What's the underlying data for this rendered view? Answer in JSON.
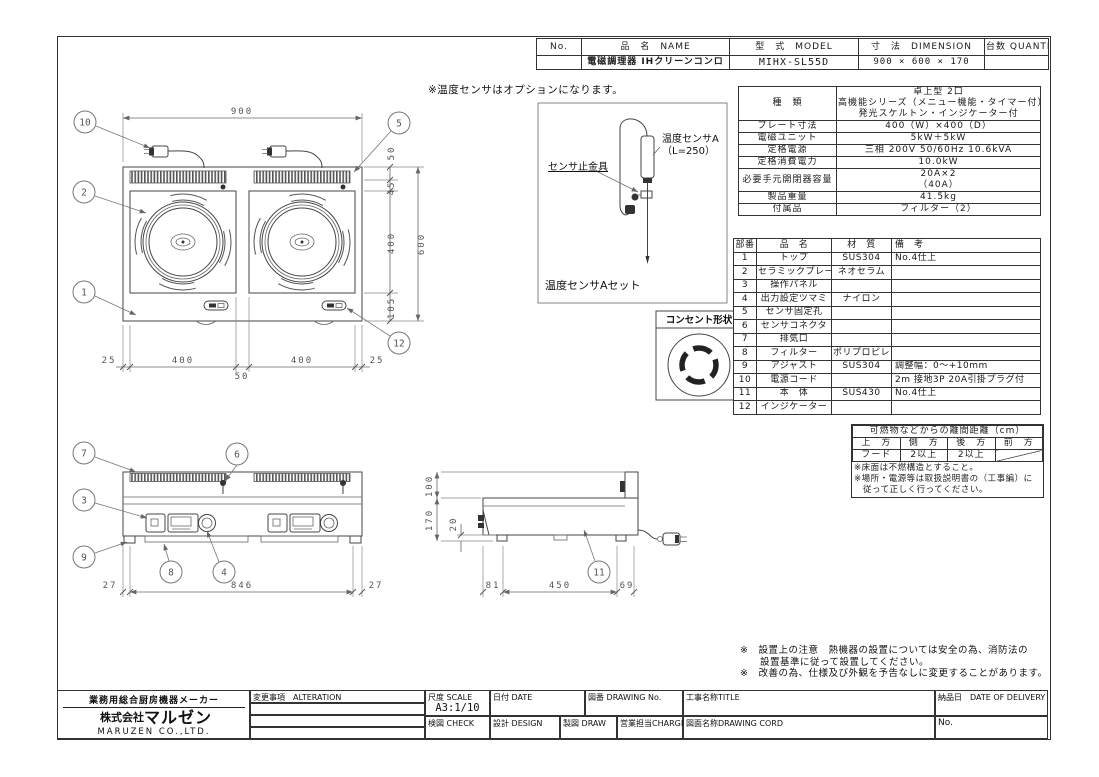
{
  "header_table": {
    "columns": [
      "No.",
      "品　名　NAME",
      "型　式　MODEL",
      "寸　法　DIMENSION",
      "台数 QUANTITY"
    ],
    "row": {
      "no": "",
      "name": "電磁調理器 IHクリーンコンロ",
      "model": "MIHX-SL55D",
      "dimension": "900 × 600 × 170",
      "quantity": ""
    }
  },
  "sensor_inset": {
    "note": "※温度センサはオプションになります。",
    "label_sensor": "温度センサA",
    "label_sensor_length": "（L=250）",
    "label_fitting": "センサ止金具",
    "caption": "温度センサAセット"
  },
  "outlet": {
    "title": "コンセント形状"
  },
  "spec_table": {
    "rows": [
      [
        "種　類",
        [
          "卓上型 2口",
          "高機能シリーズ（メニュー機能・タイマー付）",
          "発光スケルトン・インジケーター付"
        ]
      ],
      [
        "プレート寸法",
        "400（W）×400（D）"
      ],
      [
        "電磁ユニット",
        "5kW＋5kW"
      ],
      [
        "定格電源",
        "三相 200V 50/60Hz 10.6kVA"
      ],
      [
        "定格消費電力",
        "10.0kW"
      ],
      [
        "必要手元開閉器容量",
        [
          "20A×2",
          "（40A）"
        ]
      ],
      [
        "製品重量",
        "41.5kg"
      ],
      [
        "付属品",
        "フィルター（2）"
      ]
    ]
  },
  "parts_table": {
    "columns": [
      "部番",
      "品　名",
      "材　質",
      "備　考"
    ],
    "rows": [
      [
        "1",
        "トップ",
        "SUS304",
        "No.4仕上"
      ],
      [
        "2",
        "セラミックプレート",
        "ネオセラム",
        ""
      ],
      [
        "3",
        "操作パネル",
        "",
        ""
      ],
      [
        "4",
        "出力設定ツマミ",
        "ナイロン",
        ""
      ],
      [
        "5",
        "センサ固定孔",
        "",
        ""
      ],
      [
        "6",
        "センサコネクタ",
        "",
        ""
      ],
      [
        "7",
        "排気口",
        "",
        ""
      ],
      [
        "8",
        "フィルター",
        "ポリプロピレン",
        ""
      ],
      [
        "9",
        "アジャスト",
        "SUS304",
        "調整幅：0〜+10mm"
      ],
      [
        "10",
        "電源コード",
        "",
        "2m 接地3P 20A引掛プラグ付"
      ],
      [
        "11",
        "本　体",
        "SUS430",
        "No.4仕上"
      ],
      [
        "12",
        "インジケーター",
        "",
        ""
      ]
    ]
  },
  "clearance_table": {
    "title": "可燃物などからの離間距離（cm）",
    "columns": [
      "上　方",
      "側　方",
      "後　方",
      "前　方"
    ],
    "row": [
      "フード",
      "2以上",
      "2以上",
      ""
    ],
    "notes": [
      "※床面は不燃構造とすること。",
      "※場所・電源等は取扱説明書の（工事編）に",
      "　従って正しく行ってください。"
    ]
  },
  "notes": [
    "※　設置上の注意　熱機器の設置については安全の為、消防法の",
    "　　設置基準に従って設置してください。",
    "※　改善の為、仕様及び外観を予告なしに変更することがあります。"
  ],
  "title_block": {
    "maker_tagline": "業務用総合厨房機器メーカー",
    "company_prefix": "株式会社",
    "company_name": "マルゼン",
    "company_en": "MARUZEN CO.,LTD.",
    "alteration_label": "変更事項　ALTERATION",
    "scale_label": "尺度 SCALE",
    "scale_value": "A3:1/10",
    "date_label": "日付 DATE",
    "drawing_no_label": "図番 DRAWING  No.",
    "title_label": "工事名称TITLE",
    "delivery_label": "納品日　DATE OF DELIVERY",
    "check_label": "検図 CHECK",
    "design_label": "設計 DESIGN",
    "draw_label": "製図 DRAW",
    "charge_label": "営業担当CHARGE",
    "drawing_cord_label": "図面名称DRAWING  CORD",
    "no_label": "No."
  },
  "views": {
    "top": {
      "dims": {
        "overall_width": "900",
        "vent_depth": "50",
        "gap": "45",
        "plate_depth": "400",
        "front_margin": "105",
        "overall_depth": "600",
        "left_margin": "25",
        "plate_width_left": "400",
        "center_gap": "50",
        "plate_width_right": "400",
        "right_margin": "25"
      },
      "callouts": [
        "10",
        "5",
        "2",
        "1",
        "12"
      ]
    },
    "front": {
      "dims": {
        "left_inset": "27",
        "body_width": "846",
        "right_inset": "27"
      },
      "callouts": [
        "7",
        "6",
        "3",
        "9",
        "8",
        "4"
      ]
    },
    "side": {
      "dims": {
        "back_height": "100",
        "body_height": "170",
        "foot_height": "20",
        "front_inset": "81",
        "body_depth": "450",
        "back_inset": "69"
      },
      "callouts": [
        "11"
      ]
    }
  }
}
